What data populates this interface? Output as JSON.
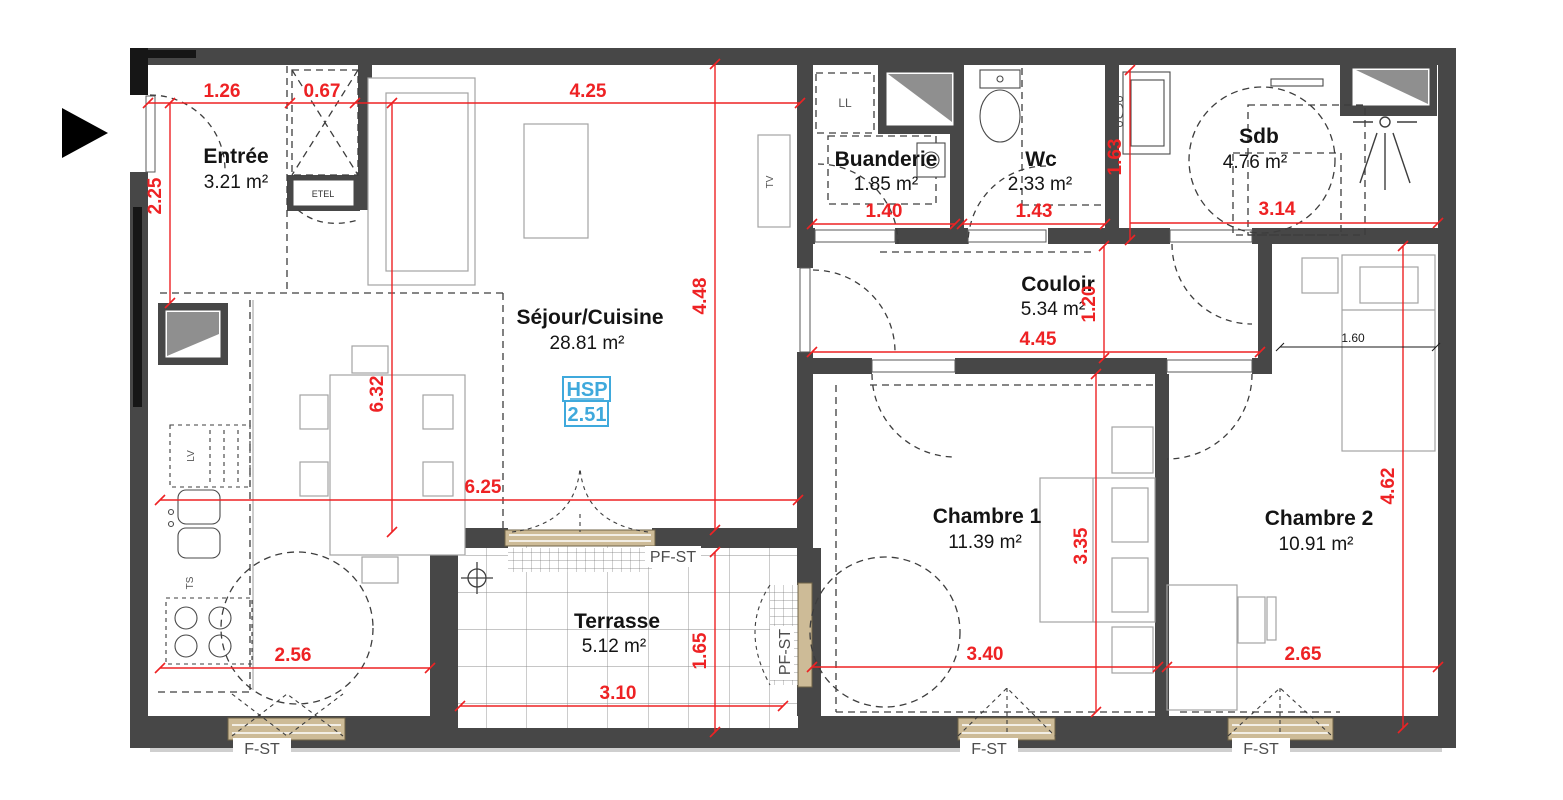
{
  "colors": {
    "dimension_red": "#ee2224",
    "wall_gray": "#474747",
    "hsp_blue": "#3fa9dc",
    "window_tan": "#cdbb97"
  },
  "rooms": {
    "entree": {
      "name": "Entrée",
      "area": "3.21 m²"
    },
    "sejour": {
      "name": "Séjour/Cuisine",
      "area": "28.81 m²"
    },
    "buanderie": {
      "name": "Buanderie",
      "area": "1.85 m²"
    },
    "wc": {
      "name": "Wc",
      "area": "2.33 m²"
    },
    "sdb": {
      "name": "Sdb",
      "area": "4.76 m²"
    },
    "couloir": {
      "name": "Couloir",
      "area": "5.34 m²"
    },
    "chambre1": {
      "name": "Chambre 1",
      "area": "11.39 m²"
    },
    "chambre2": {
      "name": "Chambre 2",
      "area": "10.91 m²"
    },
    "terrasse": {
      "name": "Terrasse",
      "area": "5.12 m²"
    }
  },
  "dimensions": {
    "d126": "1.26",
    "d067": "0.67",
    "d425": "4.25",
    "d225": "2.25",
    "d140": "1.40",
    "d143": "1.43",
    "d163": "1.63",
    "d314": "3.14",
    "d448": "4.48",
    "d632": "6.32",
    "d625": "6.25",
    "d120": "1.20",
    "d445": "4.45",
    "d335": "3.35",
    "d340": "3.40",
    "d462": "4.62",
    "d265": "2.65",
    "d256": "2.56",
    "d310": "3.10",
    "d165": "1.65",
    "d160": "1.60"
  },
  "hsp": {
    "label": "HSP",
    "value": "2.51"
  },
  "window_labels": {
    "f_st": "F-ST",
    "pf_st": "PF-ST"
  },
  "fixture_labels": {
    "etel": "ETEL",
    "ll": "LL",
    "tv": "TV",
    "lv": "LV",
    "ts": "TS"
  }
}
